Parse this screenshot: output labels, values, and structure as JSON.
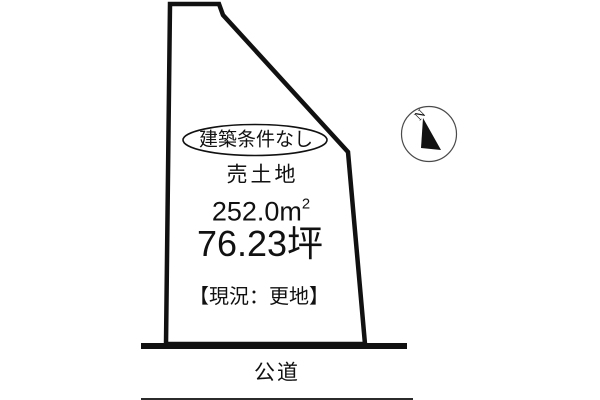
{
  "colors": {
    "background": "#ffffff",
    "line": "#111111",
    "thin_line": "#2b2b2b",
    "text": "#111111"
  },
  "parcel": {
    "badge_label": "建築条件なし",
    "sale_type": "売土地",
    "area_sqm_value": "252.0",
    "area_sqm_unit": "m",
    "area_sqm_sup": "2",
    "area_tsubo": "76.23坪",
    "status_label": "【現況：更地】"
  },
  "road": {
    "label": "公道"
  },
  "compass": {
    "north_label": "N"
  }
}
